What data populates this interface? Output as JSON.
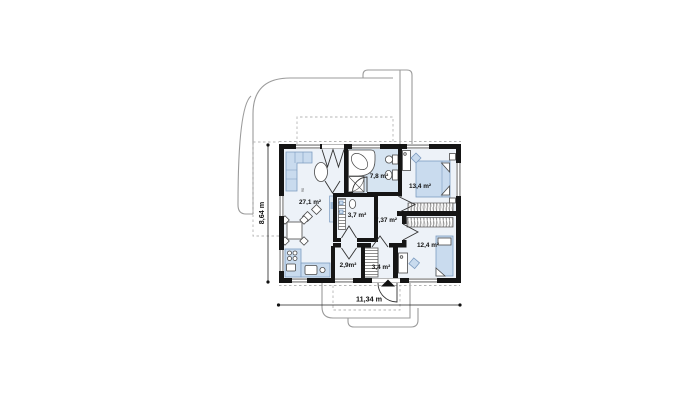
{
  "plan": {
    "rooms": [
      {
        "id": "living-room",
        "label": "27,1 m²"
      },
      {
        "id": "bathroom",
        "label": "7,8 m²"
      },
      {
        "id": "bedroom-top-right",
        "label": "13,4 m²"
      },
      {
        "id": "storage-room",
        "label": "3,7 m²"
      },
      {
        "id": "hallway",
        "label": "7,37 m²"
      },
      {
        "id": "bedroom-bottom-right",
        "label": "12,4 m²"
      },
      {
        "id": "pantry",
        "label": "2,9m²"
      },
      {
        "id": "entry-hall",
        "label": "3,4 m²"
      }
    ],
    "dimensions": {
      "width": "11,34 m",
      "height": "8,64 m"
    },
    "annotations": {
      "door_width": "90"
    },
    "colors": {
      "wall": "#151515",
      "floor": "#edf2f8",
      "bathroom_floor": "#d6e4f1",
      "furniture": "#c9dbee",
      "furniture_outline": "#7d9cc0",
      "roof_outline": "#9b9b9b",
      "dashed_outline": "#b5b5b5"
    }
  }
}
